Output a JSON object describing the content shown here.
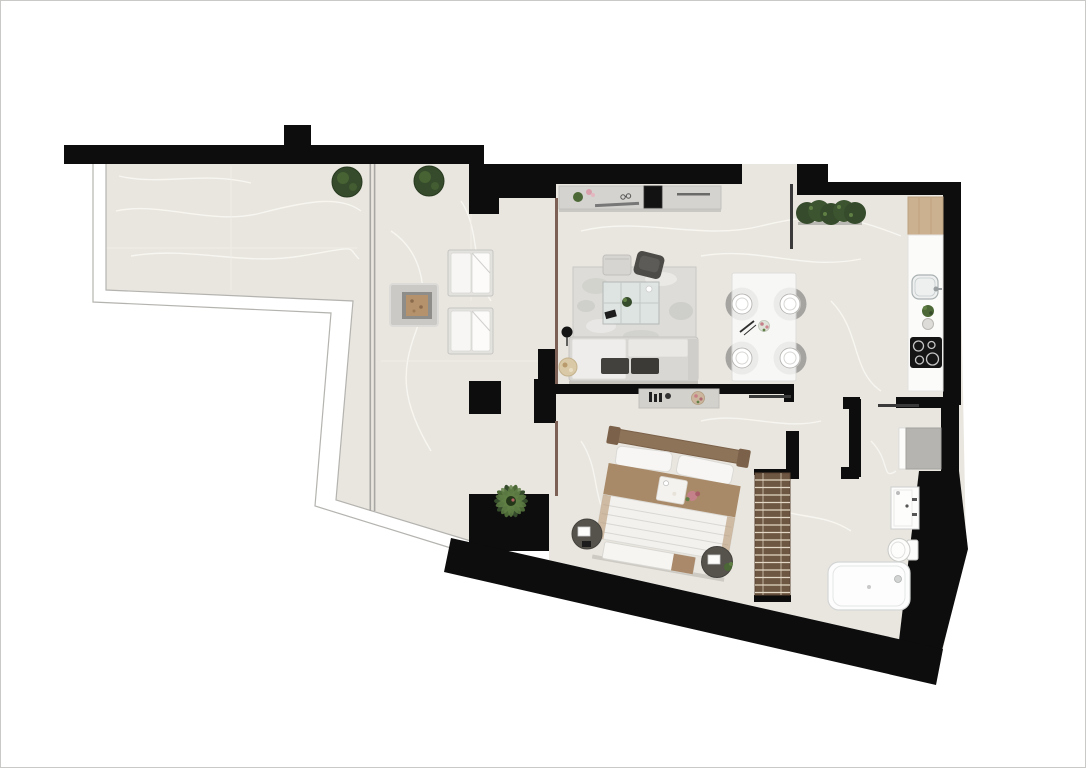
{
  "meta": {
    "title": "apartment-floor-plan",
    "view": "top-down architectural render",
    "visible_text": "none"
  },
  "canvas": {
    "width": 1086,
    "height": 768,
    "background": "#ffffff",
    "frame": "#c9c9c8"
  },
  "palette": {
    "wall": "#0d0d0d",
    "floor": "#e9e6df",
    "vein": "#f8f7f2",
    "tile": "#f1efe9",
    "balustrade_stroke": "#b4b3af",
    "white": "#ffffff",
    "glass_brown": "#7d6055",
    "divider_gray": "#a8a7a3",
    "door": "#3a3a3a",
    "plant_dark": "#354b2b",
    "plant_mid": "#4c6836",
    "plant_light": "#5f7f45",
    "lounger": "#e3e2df",
    "lounger_white": "#f7f6f4",
    "firepit_outer": "#cac9c6",
    "firepit_mid": "#8f8d89",
    "firepit_ember": "#b5916c",
    "console": "#d5d3cf",
    "tv": "#121212",
    "rug": "#dddcd8",
    "glass_table": "#dfe6e4",
    "pouf": "#d7d5d1",
    "chair_dark": "#4d4b48",
    "sofa": "#d9d7d3",
    "sofa_white": "#eeedeb",
    "cushion_dark": "#43413d",
    "lamp_black": "#141414",
    "side_table": "#d9c9a6",
    "chair_gray": "#a5a4a1",
    "chair_inner": "#c9c8c5",
    "table_white": "#fbfbfa",
    "wood": "#ccb190",
    "counter": "#fbfbf9",
    "sink": "#eef0f0",
    "cooktop": "#151515",
    "burner": "#d9d9d9",
    "appliance": "#b5b4b1",
    "bath_white": "#fdfdfc",
    "fixture_stroke": "#cbcdcd",
    "bed_headboard": "#8d7358",
    "bed_blanket": "#a98a68",
    "duvet": "#f2f1ee",
    "pillow": "#f7f6f4",
    "bench": "#f6f5f2",
    "nightstand": "#56534d",
    "wardrobe": "#6e5742",
    "wardrobe_slat": "#e2d7c4",
    "tray": "#f4f2ee",
    "pink": "#c5818a"
  },
  "rooms": [
    {
      "name": "terrace",
      "elements": [
        "potted-bush-1",
        "potted-bush-2",
        "glass-divider",
        "sun-lounger-1",
        "sun-lounger-2",
        "fire-pit-table",
        "palm-plant",
        "glass-balustrade"
      ]
    },
    {
      "name": "living-room",
      "elements": [
        "media-console",
        "tv",
        "console-plant",
        "eyeglasses-decor",
        "remote",
        "wall-shelf",
        "area-rug",
        "coffee-table",
        "coffee-table-plant",
        "book",
        "pouf",
        "accent-chair",
        "sofa",
        "floor-lamp",
        "side-table",
        "glass-partition"
      ]
    },
    {
      "name": "dining-area",
      "elements": [
        "dining-table",
        "dining-chair-1",
        "dining-chair-2",
        "dining-chair-3",
        "dining-chair-4",
        "place-setting-1",
        "place-setting-2",
        "place-setting-3",
        "place-setting-4",
        "centerpiece",
        "cutlery"
      ]
    },
    {
      "name": "kitchen",
      "elements": [
        "hedge-planter",
        "wood-countertop",
        "countertop",
        "sink",
        "faucet",
        "herb-plant",
        "jar",
        "cooktop"
      ]
    },
    {
      "name": "entry",
      "elements": [
        "entry-door"
      ]
    },
    {
      "name": "bedroom",
      "elements": [
        "dresser-console",
        "candlesticks",
        "decor-bowl",
        "bed",
        "headboard",
        "pillows",
        "blanket",
        "breakfast-tray",
        "duvet",
        "foot-bench",
        "nightstand-left",
        "nightstand-right",
        "wardrobe"
      ]
    },
    {
      "name": "hallway",
      "elements": [
        "bedroom-door",
        "bathroom-door"
      ]
    },
    {
      "name": "bathroom",
      "elements": [
        "shower-unit",
        "vanity-sink",
        "toilet",
        "bathtub"
      ]
    }
  ]
}
